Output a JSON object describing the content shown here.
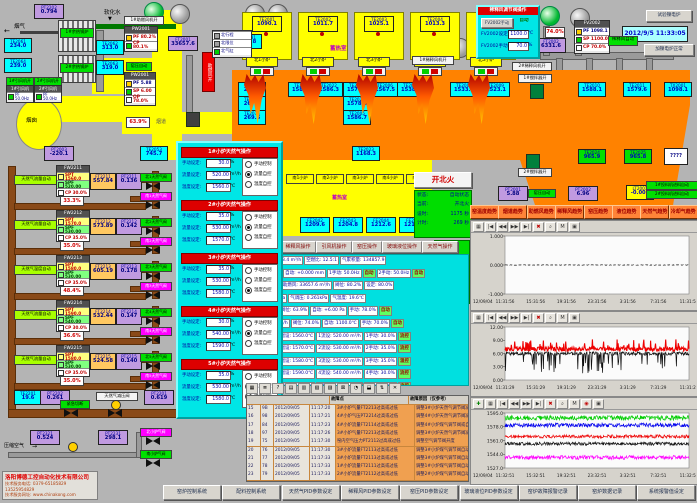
{
  "app": {
    "datetime": "2012/9/5 11:33:05",
    "company": {
      "name": "洛阳博德工控自动化技术有限公司",
      "phone": "技术服务电话: 0379-65185829  13525954829",
      "site": "技术服务网址: www.chinakong.com"
    }
  },
  "top_left": {
    "flue_gas": "烟气",
    "soft_water": "软化水",
    "boilers": [
      "1#余热锅炉",
      "2#余热锅炉"
    ],
    "chimney": "烟囱",
    "flue_label": "烟道",
    "fan_on": [
      "1#引风机开",
      "2#引风机开"
    ],
    "fan_panels": [
      {
        "title": "1#引风机",
        "row": "PF 50.0Hz"
      },
      {
        "title": "2#引风机",
        "row": "PF 50.0Hz"
      }
    ],
    "pw2001a": {
      "title": "PW2001",
      "rows": [
        [
          "PF",
          "80.2%"
        ],
        [
          "CP",
          "80.1%"
        ]
      ]
    },
    "blower_on": "1#助燃风机开",
    "kiln_press_auto": "窑压自动",
    "pw2001b": {
      "title": "PW2001",
      "rows": [
        [
          "PF",
          "5.88"
        ],
        [
          "SP",
          "6.00"
        ],
        [
          "OP",
          "78.0%"
        ]
      ]
    },
    "damper_pct": "63.9%",
    "air_bar": "助燃风开",
    "cyl_legend": [
      "北行程",
      "北限位",
      "北气缸"
    ]
  },
  "instruments": {
    "cyan": [
      {
        "t": "TE2061",
        "v": "234.0"
      },
      {
        "t": "TE2064",
        "v": "239.0"
      },
      {
        "t": "TE2062",
        "v": "313.0"
      },
      {
        "t": "TE2063",
        "v": "319.0"
      },
      {
        "t": "TE2053",
        "v": "745.7"
      },
      {
        "t": "TE2081",
        "v": "585.8"
      },
      {
        "t": "TE2201",
        "v": "19.6"
      }
    ],
    "crown": [
      {
        "t": "TE2071",
        "v": "263.0"
      },
      {
        "t": "TE2072",
        "v": "267.4"
      },
      {
        "t": "TE2073",
        "v": "269.6"
      },
      {
        "t": "TE2021",
        "v": "1586.2"
      },
      {
        "t": "TE2022",
        "v": "1586.3"
      },
      {
        "t": "TE2004",
        "v": "1570.9"
      },
      {
        "t": "TE2023",
        "v": "1578.8"
      },
      {
        "t": "TE2005",
        "v": "1586.7"
      },
      {
        "t": "TE2006",
        "v": "1567.5"
      },
      {
        "t": "TE2007",
        "v": "1538.5"
      },
      {
        "t": "TE2008",
        "v": "1533.8"
      },
      {
        "t": "TE2009",
        "v": "1523.1"
      },
      {
        "t": "TE2010",
        "v": "1588.1"
      },
      {
        "t": "TE2011",
        "v": "1579.6"
      },
      {
        "t": "TX2001",
        "v": "1098.1"
      },
      {
        "t": "TE2023",
        "v": "1168.3"
      }
    ],
    "purple": [
      {
        "t": "PT2202",
        "v": "0.794"
      },
      {
        "t": "PT2003",
        "v": "-220.1"
      },
      {
        "t": "FT2001",
        "v": "33657.6"
      },
      {
        "t": "FT2002",
        "v": "6331.6"
      },
      {
        "t": "PT2001",
        "v": "5.88"
      },
      {
        "t": "PT2002",
        "v": "6.96"
      },
      {
        "t": "PT2201",
        "v": "0.619"
      },
      {
        "t": "PT2202",
        "v": "0.261"
      },
      {
        "t": "PT2321",
        "v": "0.524"
      },
      {
        "t": "PT2231",
        "v": "298.1"
      }
    ],
    "green": [
      {
        "t": "TE2024",
        "v": "965.9"
      },
      {
        "t": "TE2025",
        "v": "965.8"
      }
    ],
    "yellow": [
      {
        "t": "LT2001",
        "v": "-0.001"
      }
    ]
  },
  "furnace": {
    "regen_label": "蓄热室",
    "regen_top": [
      [
        "TE2001",
        "1090.1"
      ],
      [
        "TE2002",
        "1011.7"
      ],
      [
        "TE2003",
        "1025.1"
      ],
      [
        "TE2004",
        "1013.3"
      ],
      [
        "TE2005",
        "1061.7"
      ]
    ],
    "north_ports": [
      "北1小炉",
      "北2小炉",
      "北3小炉",
      "北4小炉",
      "北5小炉"
    ],
    "south_ports": [
      "南1小炉",
      "南2小炉",
      "南3小炉",
      "南4小炉",
      "南5小炉"
    ],
    "south_regen_label": "蓄热室",
    "south_fe": [
      [
        "FE2042",
        "1209.6"
      ],
      [
        "FE2043",
        "1204.8"
      ],
      [
        "FE2044",
        "1212.6"
      ],
      [
        "FE2045",
        "1211.8"
      ]
    ],
    "fire_btn": "开北火",
    "status": [
      [
        "状态:",
        "自动状态"
      ],
      [
        "当前:",
        "开北火"
      ],
      [
        "设时:",
        "1175 秒"
      ],
      [
        "计时:",
        "269 秒"
      ]
    ],
    "dilution_fan1": "1#稀释风机开",
    "dilution_fan2": "2#稀释风机开",
    "stirrer1": "1#搅拌器开",
    "stirrer2": "2#搅拌器开",
    "feeders": [
      "1#投料机进料自动",
      "2#投料机进料自动"
    ],
    "unknown": "????"
  },
  "dilution_popup": {
    "title": "稀释风调节阀操作",
    "manual_btn": "FV2002手动",
    "auto_btn": "自动",
    "set_label": "FV2002设定:",
    "set_value": "1100.0",
    "set_unit": "℃",
    "man_label": "FV2002手动:",
    "man_value": "70.0",
    "man_unit": "%"
  },
  "fv2002": {
    "title": "FV2002",
    "rows": [
      [
        "PF",
        "1098.1"
      ],
      [
        "SP",
        "1100.0"
      ],
      [
        "CP",
        "70.0%"
      ]
    ]
  },
  "misc": {
    "dilution_auto": "稀释风自动",
    "pct74": "74.0%",
    "test_btn": "试验镍电炉",
    "normal_btn": "加镍电炉正常"
  },
  "gas_popup": {
    "row_labels": [
      "手动设定:",
      "流量设定:",
      "温度设定:"
    ],
    "units": [
      "%",
      "m³/h",
      "℃"
    ],
    "radios": [
      "手动控制",
      "流量自控",
      "温度自控"
    ],
    "sections": [
      {
        "title": "1#小炉天然气操作",
        "manual": "30.0",
        "flow": "520.00",
        "temp": "1560.0",
        "mode": 1
      },
      {
        "title": "2#小炉天然气操作",
        "manual": "35.0",
        "flow": "530.00",
        "temp": "1570.0",
        "mode": 1
      },
      {
        "title": "3#小炉天然气操作",
        "manual": "35.0",
        "flow": "530.00",
        "temp": "1580.0",
        "mode": 2
      },
      {
        "title": "4#小炉天然气操作",
        "manual": "30.0",
        "flow": "540.00",
        "temp": "1590.0",
        "mode": 1
      },
      {
        "title": "5#小炉天然气操作",
        "manual": "35.0",
        "flow": "530.00",
        "temp": "1580.0",
        "mode": 1
      }
    ]
  },
  "gas_lines": {
    "blocks": [
      {
        "auto_label": "天然气流量自动",
        "fw": "FW2211",
        "spt": "SPT 1560.0",
        "spf": "SPF 520.00",
        "cp": "CP 30.0%",
        "pct": "33.3%",
        "ft_t": "FT2211",
        "ft_v": "557.84",
        "pt_t": "PT2211",
        "pt_v": "0.136",
        "north": "北1天然气阀",
        "south": "南1天然气阀"
      },
      {
        "auto_label": "天然气流量自动",
        "fw": "FW2212",
        "spt": "SPT 1570.0",
        "spf": "SPF 530.00",
        "cp": "CP 35.0%",
        "pct": "35.0%",
        "ft_t": "FT2212",
        "ft_v": "573.89",
        "pt_t": "PT2212",
        "pt_v": "0.142",
        "north": "北2天然气阀",
        "south": "南2天然气阀"
      },
      {
        "auto_label": "天然气温度自动",
        "fw": "FW2213",
        "spt": "SPT 1580.0",
        "spf": "SPF 530.00",
        "cp": "CP 35.0%",
        "pct": "48.4%",
        "ft_t": "FT2213",
        "ft_v": "605.19",
        "pt_t": "PT2213",
        "pt_v": "0.178",
        "north": "北3天然气阀",
        "south": "南3天然气阀"
      },
      {
        "auto_label": "天然气流量自动",
        "fw": "FW2214",
        "spt": "SPT 1590.0",
        "spf": "SPF 540.00",
        "cp": "CP 30.0%",
        "pct": "36.6%",
        "ft_t": "FT2214",
        "ft_v": "532.44",
        "pt_t": "PT2214",
        "pt_v": "0.147",
        "north": "北4天然气阀",
        "south": "南4天然气阀"
      },
      {
        "auto_label": "天然气流量自动",
        "fw": "FW2215",
        "spt": "SPT 1580.0",
        "spf": "SPF 530.00",
        "cp": "CP 35.0%",
        "pct": "35.0%",
        "ft_t": "FT2215",
        "ft_v": "524.58",
        "pt_t": "PT2215",
        "pt_v": "0.140",
        "north": "北5天然气阀",
        "south": "南5天然气阀"
      }
    ],
    "bottom": {
      "emergency": "紧急切断",
      "reducer": "天然气减压阀",
      "compressed_air": "压缩空气",
      "north_valve": "北小炉气阀",
      "south_valve": "南小炉气阀"
    }
  },
  "ops_buttons": [
    "助燃风机操作",
    "稀释风操作",
    "引风机操作",
    "窑压操作",
    "玻璃液位操作",
    "天然气操作"
  ],
  "param_rows": [
    [
      "天然气总流量: 2693.4 m³/h",
      "空燃比: 12.5:1",
      "气累积量: 134857.9"
    ],
    [
      "液位: -0.001 mm",
      "自动: +0.000 mm",
      "1手动: 50.0Hz",
      "自动",
      "2手动: 50.0Hz",
      "自动"
    ],
    [
      "烟气温: 268.1℃",
      "助燃风: 33657.6 m³/h",
      "阀位: 80.2%",
      "设定: 80.0%"
    ],
    [
      "煤气进压: 0.619kPa",
      "气调压: 0.261kPa",
      "气温度: 19.6℃"
    ],
    [
      "窑压: +5.88 Pa",
      "阀位: 63.9%",
      "自动: +6.00 Pa",
      "手动: 78.0%",
      "自动"
    ],
    [
      "稀释风: 6331.6 m³/h",
      "阀位: 74.0%",
      "自动: 1100.0℃",
      "手动: 70.0%",
      "自动"
    ],
    [
      "1阀位: 33.3%",
      "1温设: 1560.0℃",
      "1流设: 520.00 m³/h",
      "1手动: 30.0%",
      "流控"
    ],
    [
      "2阀位: 35.0%",
      "2温设: 1570.0℃",
      "2流设: 530.00 m³/h",
      "2手动: 35.0%",
      "流控"
    ],
    [
      "3阀位: 48.4%",
      "3温设: 1580.0℃",
      "3流设: 530.00 m³/h",
      "3手动: 35.0%",
      "温控"
    ],
    [
      "4阀位: 36.6%",
      "4温设: 1590.0℃",
      "4流设: 540.00 m³/h",
      "4手动: 30.0%",
      "流控"
    ],
    [
      "5阀位: 35.0%",
      "5温设: 1580.0℃",
      "5流设: 530.00 m³/h",
      "5手动: 35.0%",
      "流控"
    ]
  ],
  "trend_buttons": [
    "窑温度趋势",
    "烟道趋势",
    "助燃风趋势",
    "稀释风趋势",
    "窑压趋势",
    "液位趋势",
    "天然气趋势",
    "冷却气趋势"
  ],
  "chart_toolbars": {
    "c1": [
      "▦",
      "|◀",
      "◀◀",
      "▶▶",
      "▶|",
      "✖",
      "⌕",
      "M",
      "▣"
    ],
    "c2": [
      "▦",
      "|◀",
      "◀◀",
      "▶▶",
      "▶|",
      "✖",
      "⌕",
      "M",
      "▣"
    ],
    "c3": [
      "✚",
      "▦",
      "|◀",
      "◀◀",
      "▶▶",
      "▶|",
      "✖",
      "⌕",
      "M",
      "◉",
      "▣"
    ]
  },
  "alarm": {
    "toolbar": [
      "▦",
      "≣",
      "?",
      "▤",
      "▥",
      "▧",
      "▨",
      "⊠",
      "◔",
      "⬓",
      "⇅",
      "✕"
    ],
    "headers": [
      "",
      "故障点",
      "故障原因（仅参考）"
    ],
    "rows": [
      [
        "15",
        "9B",
        "2012/09/05",
        "11:17:20",
        "3#小炉气量FT2213过高或过低",
        "调整3#小炉天然气调节阀减小阀"
      ],
      [
        "16",
        "98",
        "2012/09/05",
        "11:17:21",
        "4#小炉气压PT2214过高或过低",
        "调整4#小炉天然气调节阀减小阀"
      ],
      [
        "17",
        "84",
        "2012/09/05",
        "11:17:23",
        "4#小炉流量FT2114过高或过低",
        "调整4#小炉煤气调节阀或自动阀"
      ],
      [
        "18",
        "97",
        "2012/09/05",
        "11:17:26",
        "3#小炉气量FT2213过高或过低",
        "调整3#小炉天然气调节阀减小阀"
      ],
      [
        "19",
        "75",
        "2012/09/05",
        "11:17:30",
        "窑内空气压力PT2112过高或过低",
        "调整空气调节阀开度"
      ],
      [
        "20",
        "76",
        "2012/09/05",
        "11:17:30",
        "3#小炉流量FT2113过高或过低",
        "调整3#小炉煤气调节阀自动阀门"
      ],
      [
        "21",
        "77",
        "2012/09/05",
        "11:17:33",
        "3#小炉流量FT2113过高或过低",
        "调整3#小炉煤气调节阀自动阀门"
      ],
      [
        "22",
        "78",
        "2012/09/05",
        "11:17:33",
        "1#小炉流量FT2111过高或过低",
        "调整1#小炉煤气调节阀自动阀门"
      ],
      [
        "23",
        "79",
        "2012/09/05",
        "11:17:33",
        "2#小炉流量FT2112过高或过低",
        "调整2#小炉煤气调节阀自动阀门"
      ]
    ]
  },
  "nav_buttons": [
    "窑炉控制系统",
    "配料控制系统",
    "天然气PID参数设定",
    "稀释风PID参数设定",
    "窑压PID参数设定",
    "玻璃液位PID参数设定",
    "窑炉故障报警记录",
    "窑炉数据记录",
    "系统报警值设定"
  ],
  "chart_data": [
    {
      "type": "line",
      "name": "液位趋势",
      "ylabels": [
        "1.000",
        "0.000",
        "-1.000"
      ],
      "ylim": [
        -1,
        1
      ],
      "date_label": "12/09/04",
      "xticks": [
        "11:31:56",
        "15:31:56",
        "19:31:56",
        "23:31:56",
        "3:31:56",
        "7:31:56",
        "11:31:56"
      ],
      "series": [
        {
          "name": "玻璃液位",
          "color": "#202020",
          "base": 0.0,
          "noise": 0.01,
          "dashed": true
        }
      ]
    },
    {
      "type": "line",
      "name": "窑压趋势",
      "ylabels": [
        "12.00",
        "9.00",
        "6.00",
        "3.00",
        "0.00"
      ],
      "ylim": [
        0,
        12
      ],
      "date_label": "12/09/04",
      "xticks": [
        "11:31:29",
        "15:31:29",
        "19:31:29",
        "23:31:29",
        "3:31:29",
        "7:31:29",
        "11:31:29"
      ],
      "series": [
        {
          "name": "窑压设定",
          "color": "#ee0000",
          "base": 7.0,
          "noise": 0.45,
          "spike": 2.3,
          "spike_dir": 1
        },
        {
          "name": "窑压实际",
          "color": "#101010",
          "base": 6.0,
          "noise": 0.4,
          "spike": 4.6,
          "spike_dir": -1
        }
      ]
    },
    {
      "type": "line",
      "name": "小炉温度趋势",
      "ylabels": [
        "1595.0",
        "1578.0",
        "1561.0",
        "1544.0",
        "1527.0"
      ],
      "ylim": [
        1527,
        1595
      ],
      "date_label": "12/09/04",
      "xticks": [
        "11:32:51",
        "15:32:51",
        "19:32:51",
        "23:32:51",
        "3:32:51",
        "7:32:51",
        "11:32:51"
      ],
      "series": [
        {
          "name": "1#小炉温度",
          "color": "#00cc00",
          "base": 1589,
          "noise": 3.0
        },
        {
          "name": "2#小炉温度",
          "color": "#0000ee",
          "base": 1580,
          "noise": 2.5
        },
        {
          "name": "3#小炉温度",
          "color": "#ee0000",
          "base": 1566,
          "noise": 2.0
        },
        {
          "name": "4#小炉温度",
          "color": "#101010",
          "base": 1557,
          "noise": 2.0
        },
        {
          "name": "5#小炉温度",
          "color": "#ff00ff",
          "base": 1540,
          "noise": 2.5
        }
      ]
    }
  ]
}
